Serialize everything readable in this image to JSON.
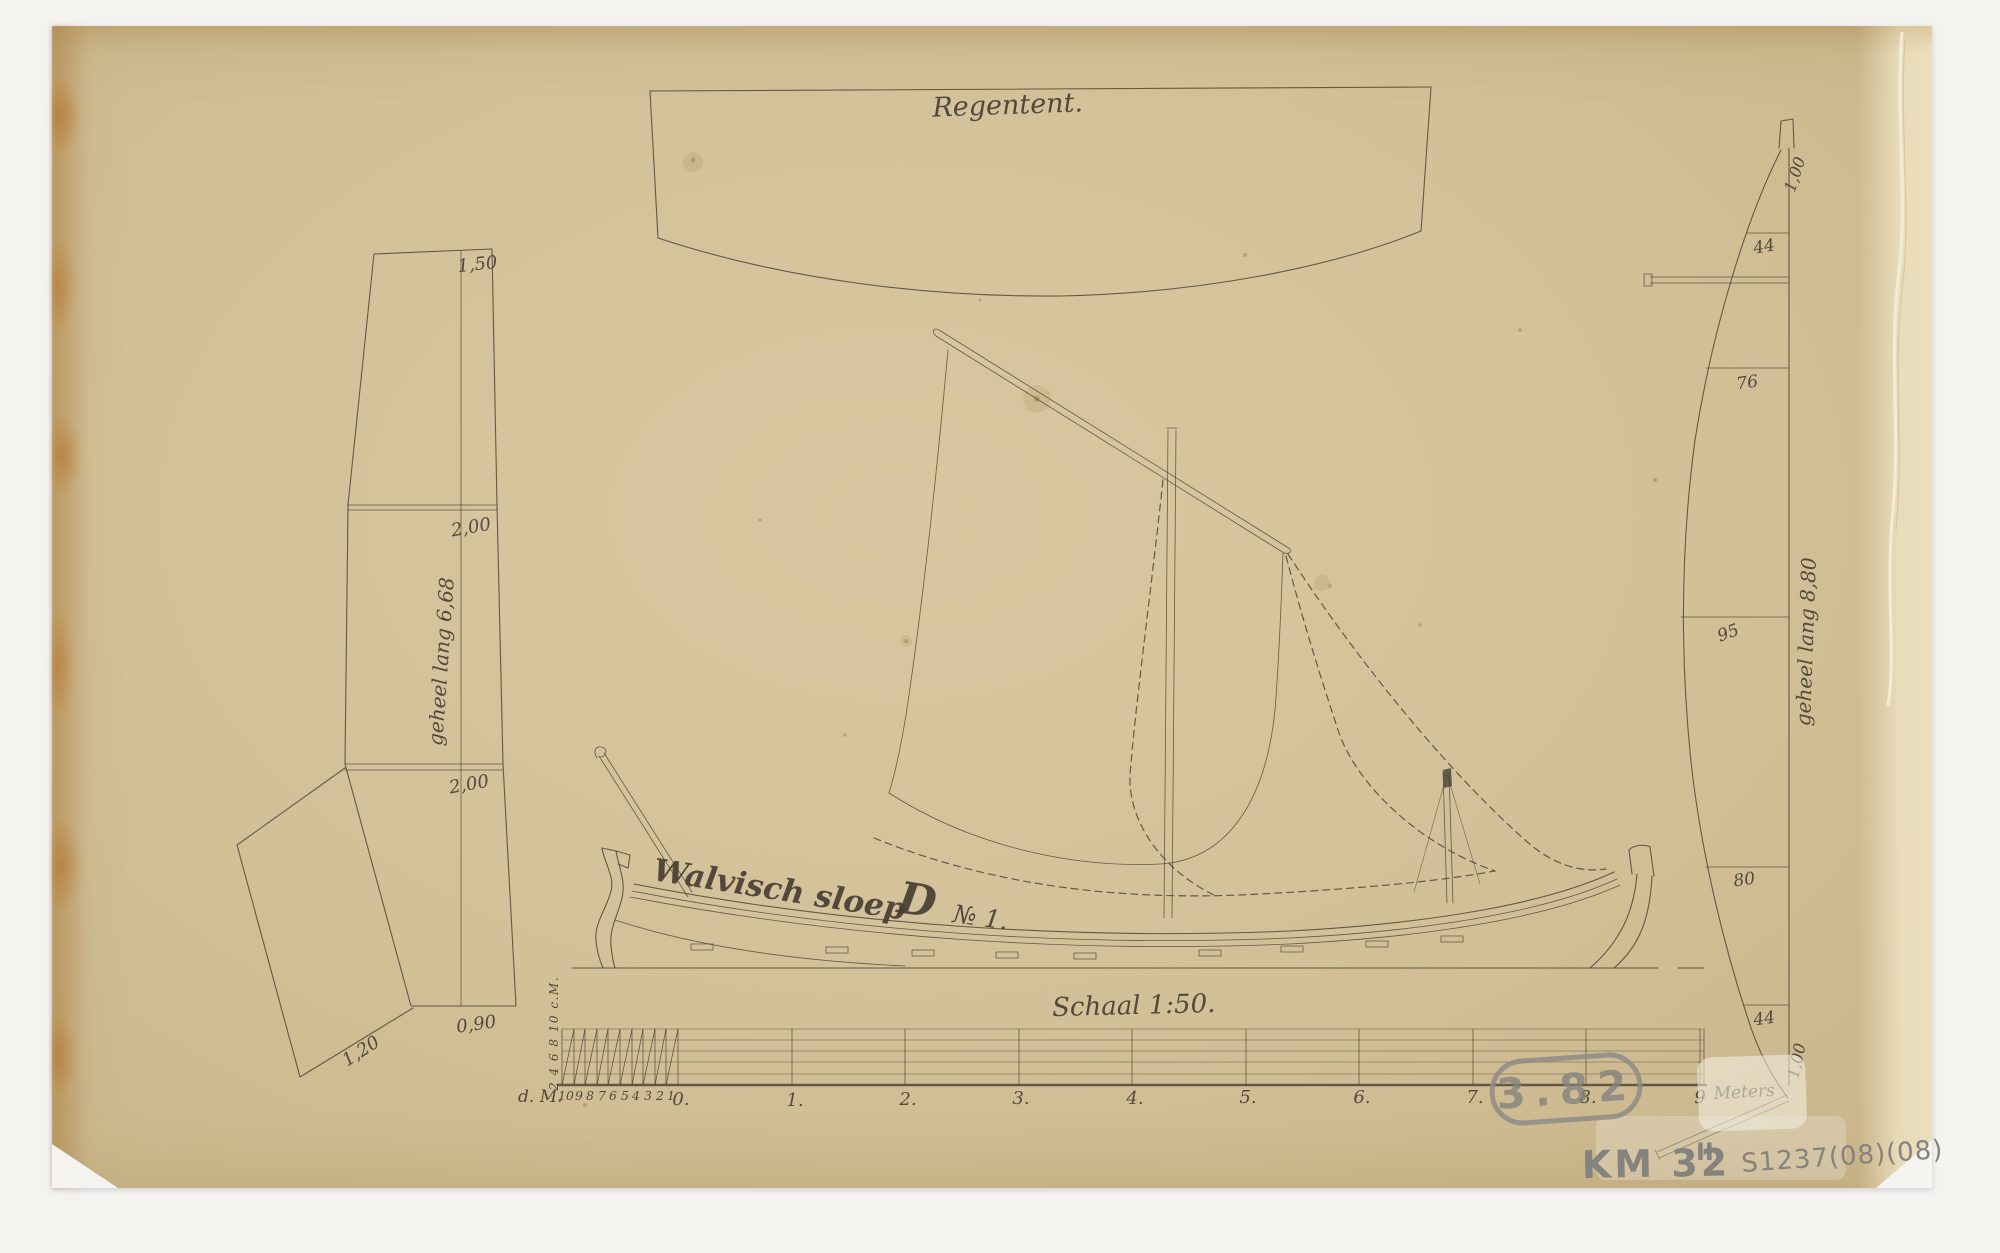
{
  "document": {
    "background_color": "#f4f3f0",
    "paper_color": "#d3c199",
    "ink_color": "#4a4237",
    "pencil_color": "#8d8c87"
  },
  "title_panel": {
    "label": "Regentent."
  },
  "keel_plank": {
    "top_width": "1,50",
    "upper_seam_width": "2,00",
    "length_label": "geheel lang 6,68",
    "lower_seam_width": "2,00",
    "bottom_width": "0,90",
    "side_panel_width": "1,20"
  },
  "sloop": {
    "name": "Walvisch sloep",
    "monogram": "D",
    "number": "№ 1."
  },
  "scale_bar": {
    "title": "Schaal 1:50.",
    "left_unit": "d. M.",
    "decimeter_ticks": [
      "10",
      "9",
      "8",
      "7",
      "6",
      "5",
      "4",
      "3",
      "2",
      "1"
    ],
    "meter_ticks": [
      "0.",
      "1.",
      "2.",
      "3.",
      "4.",
      "5.",
      "6.",
      "7.",
      "8.",
      "9"
    ],
    "meter_unit": "Meters",
    "vertical_scale_label": "2 4 6 8 10 c.M."
  },
  "sail_plan": {
    "length_label": "geheel lang 8,80",
    "head_width": "1,00",
    "seam_widths": [
      "44",
      "76",
      "95",
      "80",
      "44"
    ],
    "foot_width": "1,00"
  },
  "annotations": {
    "stamp_number": "3.82",
    "inventory_code": "KM 32",
    "inventory_suffix": "II",
    "catalog_code": "S1237(08)(08)"
  }
}
